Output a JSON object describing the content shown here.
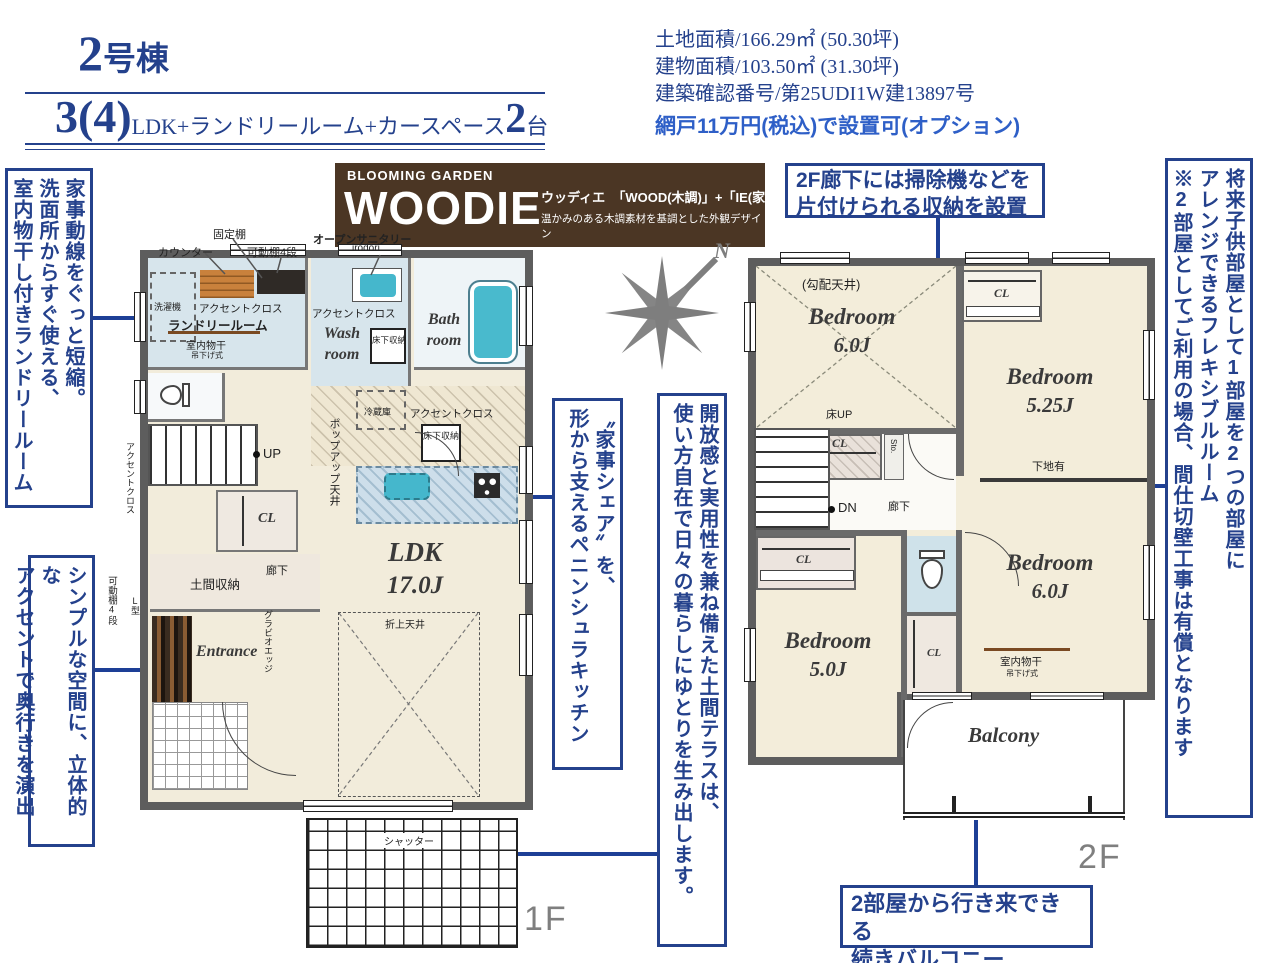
{
  "header": {
    "title_num": "2",
    "title_suffix": "号棟",
    "plan": {
      "num": "3(4)",
      "desc": "LDK+ランドリールーム+カースペース",
      "count": "2",
      "unit": "台"
    },
    "specs": [
      "土地面積/166.29㎡ (50.30坪)",
      "建物面積/103.50㎡ (31.30坪)",
      "建築確認番号/第25UDI1W建13897号"
    ],
    "option": "網戸11万円(税込)で設置可(オプション)"
  },
  "logo": {
    "brand": "BLOOMING GARDEN",
    "name": "WOODIE",
    "reading": "ウッディエ",
    "formula": "「WOOD(木調)」+「IE(家)」",
    "tagline": "温かみのある木調素材を基調とした外観デザイン"
  },
  "compass": {
    "north": "N"
  },
  "callouts": {
    "laundry": {
      "lines": [
        "家事動線をぐっと短縮。",
        "洗面所からすぐ使える、",
        "室内物干し付きランドリールーム"
      ]
    },
    "accent": {
      "lines": [
        "シンプルな空間に、立体的な",
        "アクセントで奥行きを演出"
      ]
    },
    "kitchen": {
      "lines": [
        "〝家事シェア〟を、",
        "形から支えるペニンシュラキッチン"
      ]
    },
    "terrace": {
      "lines": [
        "開放感と実用性を兼ね備えた土間テラスは、",
        "使い方自在で日々の暮らしにゆとりを生み出します。"
      ]
    },
    "storage2f": {
      "lines": [
        "2F廊下には掃除機などを",
        "片付けられる収納を設置"
      ]
    },
    "flexible": {
      "lines": [
        "将来子供部屋として1部屋を2つの部屋に",
        "アレンジできるフレキシブルルーム",
        "※2部屋としてご利用の場合、間仕切壁工事は有償となります"
      ]
    },
    "balcony": {
      "lines": [
        "2部屋から行き来できる",
        "続きバルコニー"
      ]
    }
  },
  "floor1": {
    "floor_label": "1F",
    "shelf_fixed": "固定棚",
    "counter": "カウンター",
    "shelf_movable": "可動棚4段",
    "open_sanitary": "オープンサニタリー",
    "open_sanitary_name": "irodori",
    "washer": "洗濯機",
    "accent_cloth_laundry": "アクセントクロス",
    "laundry_room": "ランドリールーム",
    "indoor_drying": "室内物干",
    "drying_type": "吊下げ式",
    "accent_cloth_wash": "アクセントクロス",
    "wash_room_1": "Wash",
    "wash_room_2": "room",
    "underfloor_wash": "床下収納",
    "bath_room_1": "Bath",
    "bath_room_2": "room",
    "fridge": "冷蔵庫",
    "accent_cloth_kitchen": "アクセントクロス",
    "underfloor_kitchen": "床下収納",
    "popup_ceiling": "ポップアップ天井",
    "up": "UP",
    "cl": "CL",
    "doma_storage": "土間収納",
    "hallway": "廊下",
    "gravio_edge": "グラビオエッジ",
    "l_type": "L型",
    "accent_cloth_hall": "アクセントクロス",
    "shelf_movable_side": "可動棚4段",
    "entrance": "Entrance",
    "ldk_1": "LDK",
    "ldk_2": "17.0J",
    "folded_ceiling": "折上天井",
    "shutter": "シャッター"
  },
  "floor2": {
    "floor_label": "2F",
    "sloped_ceiling": "(勾配天井)",
    "bedroom6a_1": "Bedroom",
    "bedroom6a_2": "6.0J",
    "floor_up": "床UP",
    "cl_mid": "CL",
    "sto": "Sto.",
    "dn": "DN",
    "hallway": "廊下",
    "cl_tr": "CL",
    "bedroom525_1": "Bedroom",
    "bedroom525_2": "5.25J",
    "shitaji": "下地有",
    "bedroom6b_1": "Bedroom",
    "bedroom6b_2": "6.0J",
    "indoor_drying": "室内物干",
    "drying_type": "吊下げ式",
    "cl_bl": "CL",
    "cl_bm": "CL",
    "bedroom5_1": "Bedroom",
    "bedroom5_2": "5.0J",
    "balcony": "Balcony"
  }
}
